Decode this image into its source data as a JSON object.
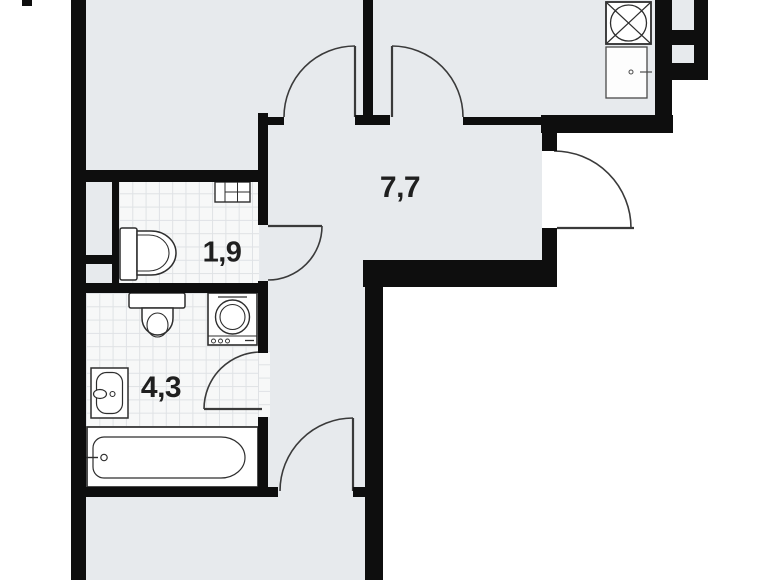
{
  "rooms": {
    "hallway": {
      "area_label": "7,7"
    },
    "wc": {
      "area_label": "1,9"
    },
    "bathroom": {
      "area_label": "4,3"
    }
  },
  "fixtures": [
    "kitchen-sink",
    "kitchen-counter",
    "wc-cabinet",
    "wc-toilet",
    "bathroom-toilet",
    "washing-machine",
    "bathroom-sink",
    "bathtub",
    "ventilation-shaft",
    "ventilation-shaft"
  ],
  "doors": [
    "room-door",
    "kitchen-door",
    "wc-door",
    "bathroom-door",
    "bottom-room-door",
    "entrance-door"
  ],
  "colors": {
    "wall": "#0e0e0e",
    "floor": "#e7eaed",
    "tile_floor": "#f7f8f8",
    "tile_grid": "#dfe2e5",
    "fixture_line": "#2e2e2e",
    "door_line": "#3a3a3a",
    "label_text": "#1f1f1f",
    "outside": "#ffffff"
  }
}
